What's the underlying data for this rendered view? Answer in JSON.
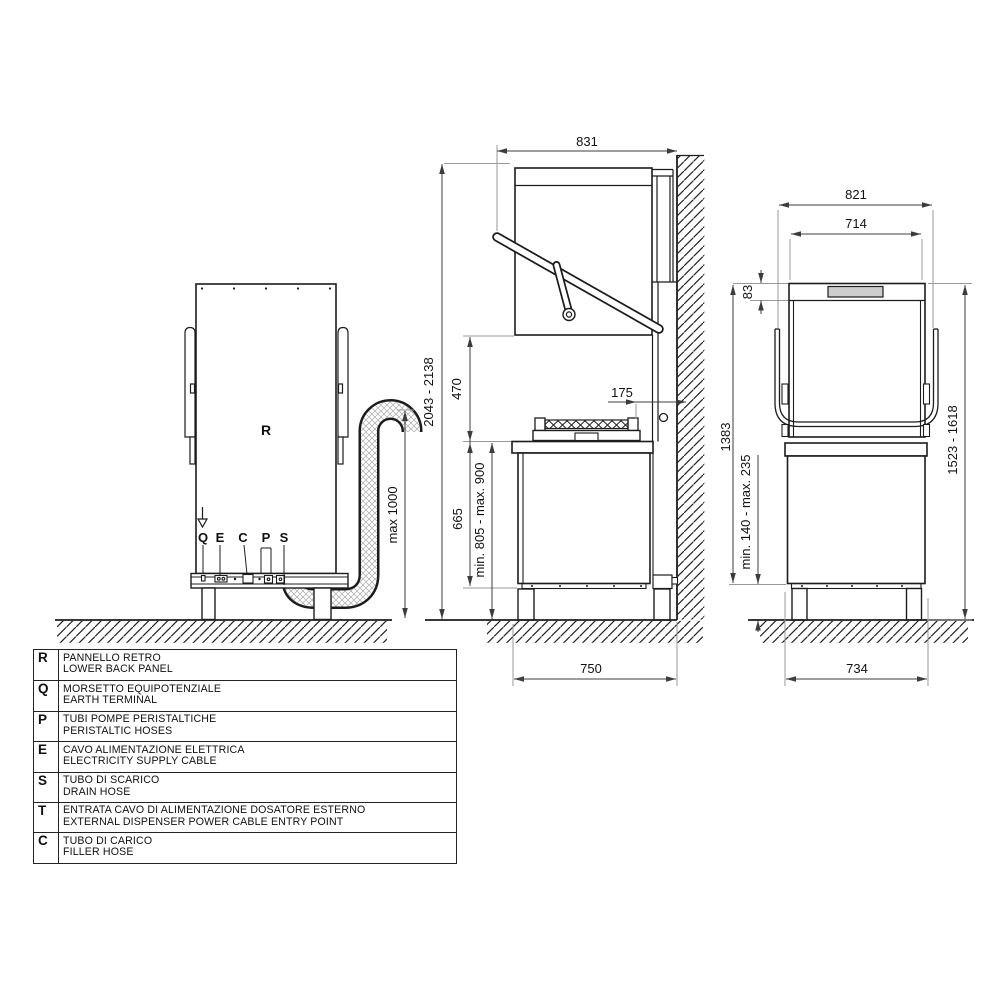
{
  "legend": {
    "rows": [
      {
        "key": "R",
        "line1": "PANNELLO RETRO",
        "line2": "LOWER BACK PANEL"
      },
      {
        "key": "Q",
        "line1": "MORSETTO EQUIPOTENZIALE",
        "line2": "EARTH TERMINAL"
      },
      {
        "key": "P",
        "line1": "TUBI POMPE PERISTALTICHE",
        "line2": "PERISTALTIC HOSES"
      },
      {
        "key": "E",
        "line1": "CAVO ALIMENTAZIONE ELETTRICA",
        "line2": "ELECTRICITY SUPPLY CABLE"
      },
      {
        "key": "S",
        "line1": "TUBO DI SCARICO",
        "line2": "DRAIN HOSE"
      },
      {
        "key": "T",
        "line1": "ENTRATA CAVO DI ALIMENTAZIONE DOSATORE ESTERNO",
        "line2": "EXTERNAL DISPENSER POWER CABLE ENTRY POINT"
      },
      {
        "key": "C",
        "line1": "TUBO DI CARICO",
        "line2": "FILLER HOSE"
      }
    ]
  },
  "back_view": {
    "panel_label": "R",
    "label_q": "Q",
    "label_e": "E",
    "label_c": "C",
    "label_p": "P",
    "label_s": "S",
    "dim_drain_hose_max_height": "max 1000"
  },
  "side_view": {
    "dim_depth_total": "831",
    "dim_height_total": "2043 - 2138",
    "dim_hood_opening": "470",
    "dim_wall_gap": "175",
    "dim_body_height": "665",
    "dim_work_height": "min. 805 - max. 900",
    "dim_depth_base": "750"
  },
  "front_view": {
    "dim_width_total": "821",
    "dim_width_hood": "714",
    "dim_panel_height": "83",
    "dim_body_height": "1383",
    "dim_height_closed": "1523 - 1618",
    "dim_leg_height": "min. 140 - max. 235",
    "dim_width_base": "734"
  }
}
